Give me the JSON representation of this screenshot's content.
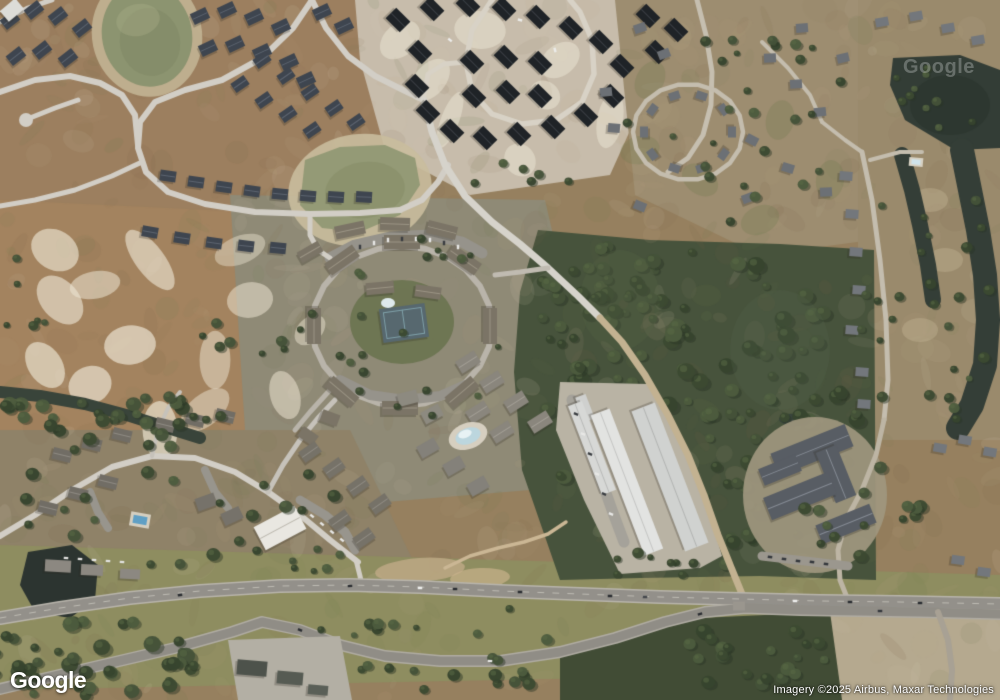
{
  "overlays": {
    "logo_text": "Google",
    "attribution_text": "Imagery ©2025 Airbus, Maxar Technologies",
    "watermark_text": "Google"
  },
  "map": {
    "view_mode": "satellite",
    "scene": {
      "features": [
        "residential subdivision with slate roofs and retention pond (top left)",
        "new subdivision with dark roofs on sandy lots (top center)",
        "mobile-home loop neighborhood (top right)",
        "dark ponds and water channels with canal-front homes (right edge)",
        "apartment ring complex with tennis court and pool (center)",
        "cleared brown dirt field with white sand patches (left middle)",
        "dense pine forest (center right)",
        "long white self-storage warehouses (bottom center)",
        "large gray-roofed institutional building complex (bottom right)",
        "divided highway with grassy median (bottom)",
        "condo neighborhood with pools (bottom left)"
      ],
      "palette": {
        "dirt": "#9c7f5f",
        "dirt_field": "#a3835f",
        "sand_patch": "#ece4d2",
        "sandy_lots": "#c7bcab",
        "forest": "#47533c",
        "pond_olive": "#8c9470",
        "water_dark": "#333d36",
        "road": "#d2cec6",
        "asphalt": "#93908a",
        "roof_slate": "#3e454f",
        "roof_black": "#1f2327",
        "roof_storage": "#e2e3e1",
        "roof_complex": "#585d64",
        "pool_blue": "#5f9fc4",
        "grass_band": "#8e8d60",
        "cleared_lot": "#b5a98f"
      }
    }
  }
}
